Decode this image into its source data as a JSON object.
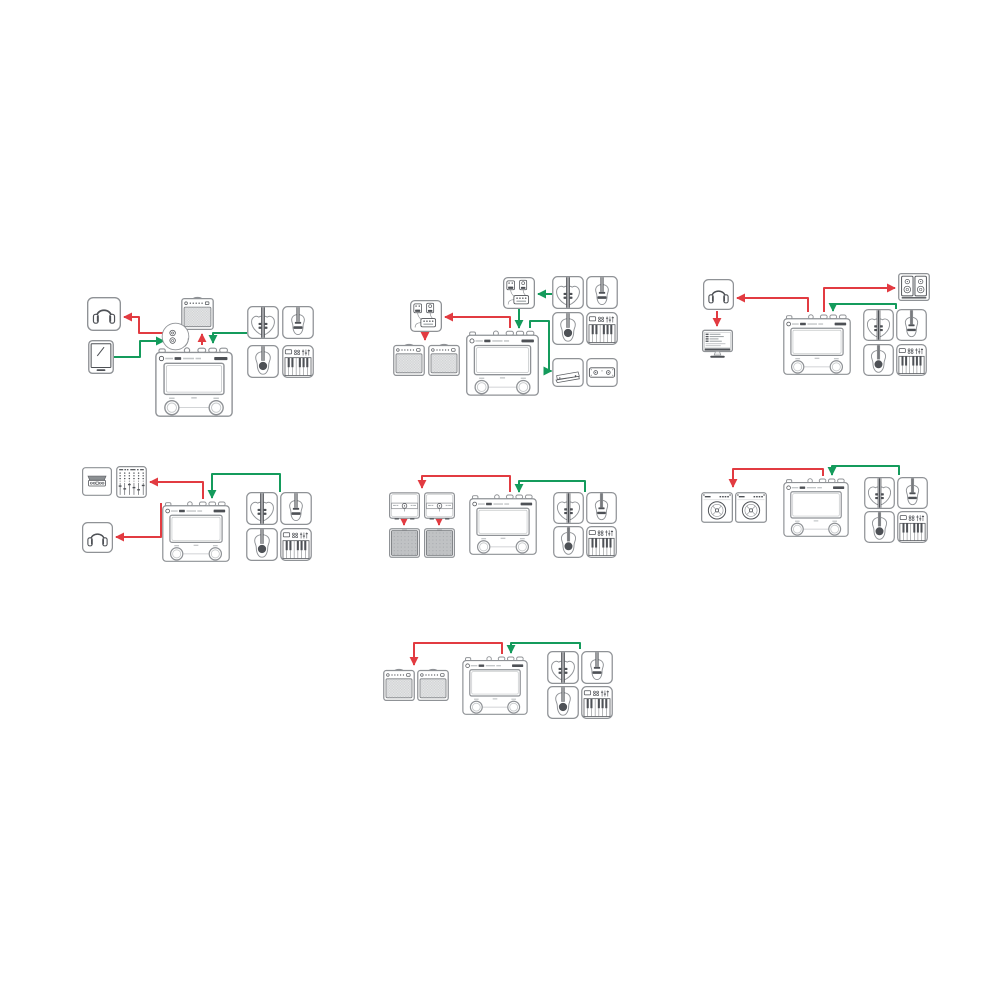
{
  "diagram": {
    "kind": "audio-connection-setups",
    "main_device": "effects-processor",
    "signal_colors": {
      "output": "#e23b41",
      "input": "#149b5c"
    },
    "palette": {
      "outline": "#8f9296",
      "detail": "#4e5156",
      "background": "#ffffff"
    },
    "setups": [
      {
        "id": 1,
        "position": "top-left",
        "components": [
          "headphones",
          "smartphone",
          "guitar-combo-amp",
          "output-jacks-detail",
          "effects-processor",
          "electric-guitar",
          "classical-guitar",
          "acoustic-guitar",
          "midi-keyboard"
        ],
        "connections": [
          {
            "from": "effects-processor",
            "to": "headphones",
            "signal": "output"
          },
          {
            "from": "effects-processor",
            "to": "guitar-combo-amp",
            "signal": "output"
          },
          {
            "from": "smartphone",
            "to": "effects-processor",
            "signal": "input"
          },
          {
            "from": "instruments",
            "to": "effects-processor",
            "signal": "input"
          }
        ]
      },
      {
        "id": 2,
        "position": "top-center",
        "components": [
          "stompbox-chain",
          "stompbox-chain",
          "guitar-combo-amp",
          "guitar-combo-amp",
          "effects-processor",
          "electric-guitar",
          "classical-guitar",
          "acoustic-guitar",
          "midi-keyboard",
          "expression-pedal",
          "dual-footswitch"
        ],
        "connections": [
          {
            "from": "instruments",
            "to": "stompbox-chain",
            "signal": "input"
          },
          {
            "from": "stompbox-chain",
            "to": "effects-processor",
            "signal": "input"
          },
          {
            "from": "effects-processor",
            "to": "stompbox-chain",
            "signal": "output"
          },
          {
            "from": "stompbox-chain",
            "to": "guitar-combo-amps",
            "signal": "output"
          },
          {
            "from": "effects-processor",
            "to": "expression-pedal",
            "signal": "input"
          }
        ]
      },
      {
        "id": 3,
        "position": "top-right",
        "components": [
          "headphones",
          "computer-daw",
          "studio-monitors",
          "effects-processor",
          "electric-guitar",
          "classical-guitar",
          "acoustic-guitar",
          "midi-keyboard"
        ],
        "connections": [
          {
            "from": "effects-processor",
            "to": "headphones",
            "signal": "output"
          },
          {
            "from": "effects-processor",
            "to": "computer-daw",
            "signal": "output"
          },
          {
            "from": "effects-processor",
            "to": "studio-monitors",
            "signal": "output"
          },
          {
            "from": "instruments",
            "to": "effects-processor",
            "signal": "input"
          }
        ]
      },
      {
        "id": 4,
        "position": "middle-left",
        "components": [
          "audio-interface",
          "mixing-console",
          "headphones",
          "effects-processor",
          "electric-guitar",
          "classical-guitar",
          "acoustic-guitar",
          "midi-keyboard"
        ],
        "connections": [
          {
            "from": "effects-processor",
            "to": "mixing-console",
            "signal": "output"
          },
          {
            "from": "effects-processor",
            "to": "headphones",
            "signal": "output"
          },
          {
            "from": "instruments",
            "to": "effects-processor",
            "signal": "input"
          }
        ]
      },
      {
        "id": 5,
        "position": "middle-center",
        "components": [
          "power-amp-head",
          "power-amp-head",
          "speaker-cabinet",
          "speaker-cabinet",
          "effects-processor",
          "electric-guitar",
          "classical-guitar",
          "acoustic-guitar",
          "midi-keyboard"
        ],
        "connections": [
          {
            "from": "effects-processor",
            "to": "power-amp-heads",
            "signal": "output"
          },
          {
            "from": "power-amp-head",
            "to": "speaker-cabinet",
            "signal": "output"
          },
          {
            "from": "power-amp-head",
            "to": "speaker-cabinet",
            "signal": "output"
          },
          {
            "from": "instruments",
            "to": "effects-processor",
            "signal": "input"
          }
        ]
      },
      {
        "id": 6,
        "position": "middle-right",
        "components": [
          "round-speaker-combo-amp",
          "round-speaker-combo-amp",
          "effects-processor",
          "electric-guitar",
          "classical-guitar",
          "acoustic-guitar",
          "midi-keyboard"
        ],
        "connections": [
          {
            "from": "effects-processor",
            "to": "combo-amps",
            "signal": "output"
          },
          {
            "from": "instruments",
            "to": "effects-processor",
            "signal": "input"
          }
        ]
      },
      {
        "id": 7,
        "position": "bottom-center",
        "components": [
          "guitar-combo-amp",
          "guitar-combo-amp",
          "effects-processor",
          "electric-guitar",
          "classical-guitar",
          "acoustic-guitar",
          "midi-keyboard"
        ],
        "connections": [
          {
            "from": "effects-processor",
            "to": "guitar-combo-amps",
            "signal": "output"
          },
          {
            "from": "instruments",
            "to": "effects-processor",
            "signal": "input"
          }
        ]
      }
    ]
  }
}
